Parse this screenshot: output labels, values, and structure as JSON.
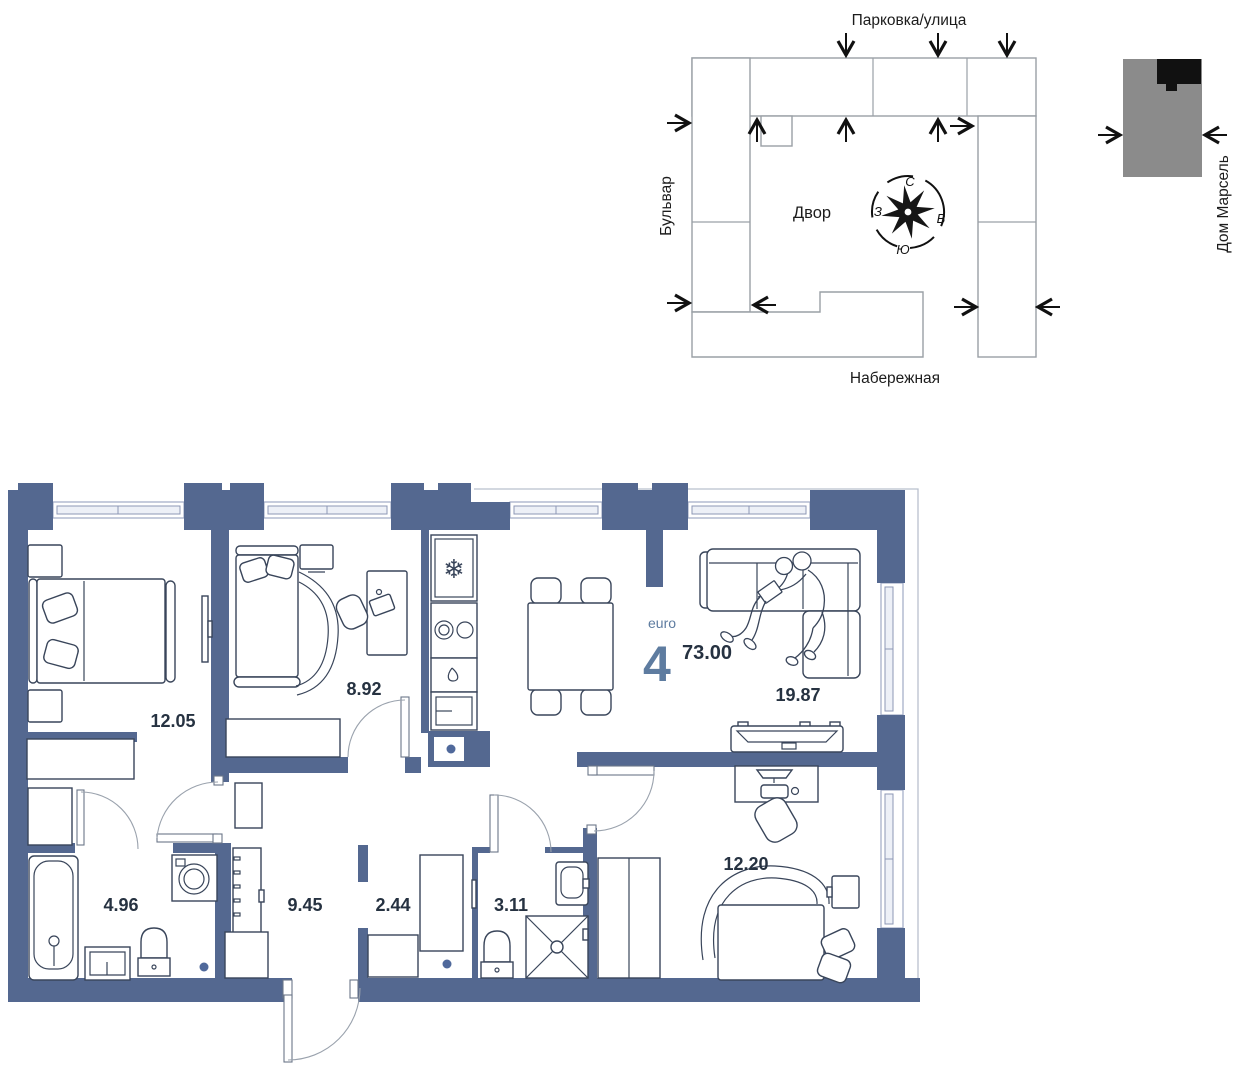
{
  "site_plan": {
    "top_street": "Парковка/улица",
    "left_street": "Бульвар",
    "bottom_street": "Набережная",
    "building_label": "Дом Марсель",
    "courtyard_label": "Двор",
    "compass": {
      "n": "С",
      "e": "В",
      "s": "Ю",
      "w": "З"
    }
  },
  "apartment": {
    "type_label": "euro",
    "rooms_count": "4",
    "total_area": "73.00",
    "areas": {
      "bedroom_main": "12.05",
      "bedroom_kids": "8.92",
      "living_kitchen": "19.87",
      "bedroom_third": "12.20",
      "hallway": "9.45",
      "wardrobe_room": "2.44",
      "shower_room": "3.11",
      "bathroom": "4.96"
    }
  },
  "icons": {
    "fridge_snowflake": "❄"
  },
  "colors": {
    "wall": "#546890",
    "accent": "#5e7ca0",
    "text_dark": "#263241",
    "site_stroke": "#9aa0a6",
    "building_grey": "#8b8b8b",
    "building_black": "#111111"
  }
}
